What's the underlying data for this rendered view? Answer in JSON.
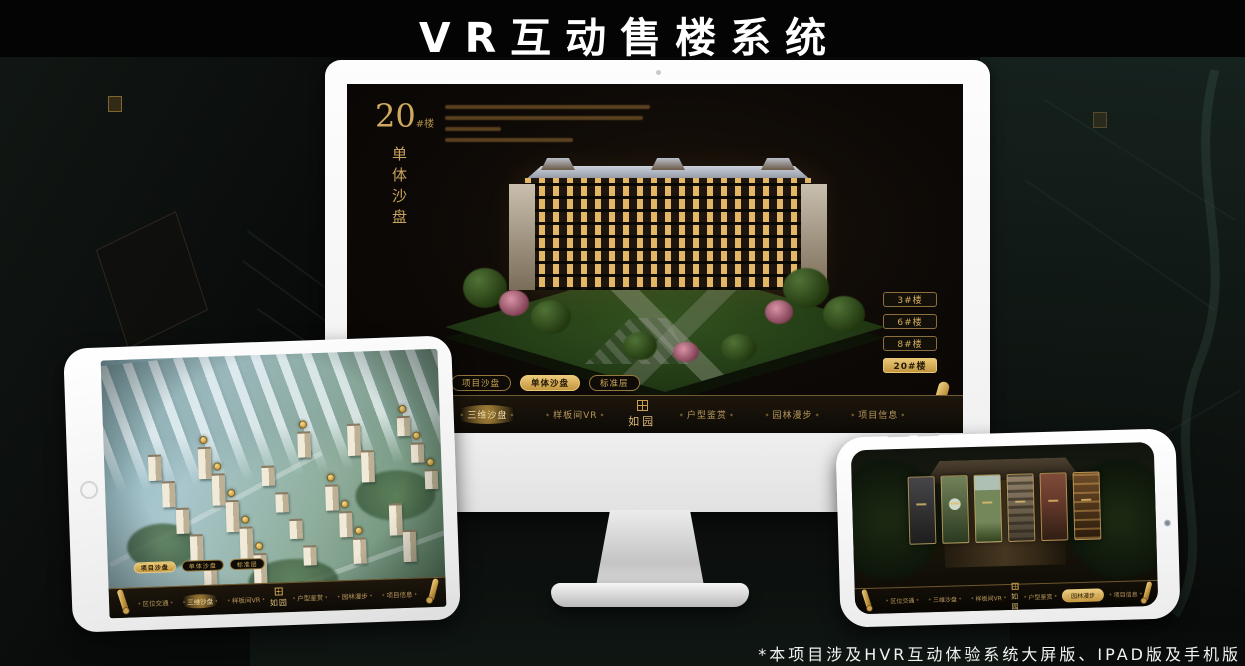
{
  "title": "VR互动售楼系统",
  "footnote": "*本项目涉及HVR互动体验系统大屏版、IPAD版及手机版",
  "colors": {
    "gold": "#d2ab5e",
    "gold_selected_bg": "#e9c777",
    "screen_bg": "#0d0906"
  },
  "desktop": {
    "block_number": "20",
    "block_suffix": "#楼",
    "section_title": "单体沙盘",
    "building_buttons": [
      {
        "label": "3#楼",
        "selected": false
      },
      {
        "label": "6#楼",
        "selected": false
      },
      {
        "label": "8#楼",
        "selected": false
      },
      {
        "label": "20#楼",
        "selected": true
      }
    ],
    "sub_tabs": [
      {
        "label": "项目沙盘",
        "selected": false
      },
      {
        "label": "单体沙盘",
        "selected": true
      },
      {
        "label": "标准层",
        "selected": false
      }
    ],
    "nav": {
      "items": [
        {
          "label": "区位交通",
          "selected": false
        },
        {
          "label": "三维沙盘",
          "selected": true
        },
        {
          "label": "样板间VR",
          "selected": false
        },
        {
          "label": "户型鉴赏",
          "selected": false
        },
        {
          "label": "园林漫步",
          "selected": false
        },
        {
          "label": "项目信息",
          "selected": false
        }
      ],
      "logo": "如园"
    }
  },
  "ipad": {
    "sub_tabs": [
      {
        "label": "项目沙盘",
        "selected": true
      },
      {
        "label": "单体沙盘",
        "selected": false
      },
      {
        "label": "标准层",
        "selected": false
      }
    ],
    "nav": {
      "items": [
        {
          "label": "区位交通",
          "selected": false
        },
        {
          "label": "三维沙盘",
          "selected": true
        },
        {
          "label": "样板间VR",
          "selected": false
        },
        {
          "label": "户型鉴赏",
          "selected": false
        },
        {
          "label": "园林漫步",
          "selected": false
        },
        {
          "label": "项目信息",
          "selected": false
        }
      ],
      "logo": "如园"
    }
  },
  "phone": {
    "nav": {
      "items": [
        {
          "label": "区位交通",
          "selected": false
        },
        {
          "label": "三维沙盘",
          "selected": false
        },
        {
          "label": "样板间VR",
          "selected": false
        },
        {
          "label": "户型鉴赏",
          "selected": false
        },
        {
          "label": "园林漫步",
          "selected": true
        },
        {
          "label": "项目信息",
          "selected": false
        }
      ],
      "logo": "如园"
    }
  }
}
